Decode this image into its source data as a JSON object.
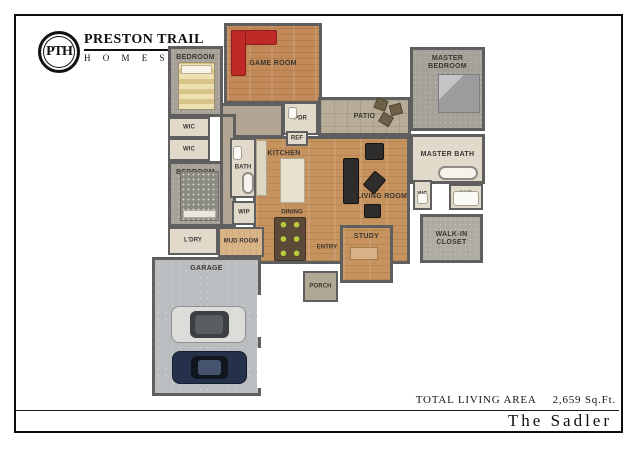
{
  "brand": {
    "monogram": "PTH",
    "name_line1": "PRESTON TRAIL",
    "name_line2": "H O M E S"
  },
  "footer": {
    "total_label": "TOTAL LIVING AREA",
    "total_value": "2,659 Sq.Ft.",
    "plan_name": "The Sadler"
  },
  "floorplan": {
    "colors": {
      "wall": "#5f5f5f",
      "wood": "#c6925d",
      "woodGame": "#c18a58",
      "woodLight": "#d9b487",
      "carpet": "#a5a199",
      "carpetWalkin": "#aeaba1",
      "tile": "#e1dacb",
      "taupe": "#b2a593",
      "patio": "#b7ad99",
      "concrete": "#babdbf",
      "porch": "#b1a795",
      "sofaRed": "#bf2a27",
      "seatDark": "#2e2d2b",
      "tableBrown": "#5c4a39",
      "chairGreen": "#b9cc3d"
    },
    "rooms": [
      {
        "id": "hall-upper",
        "label": "",
        "x": 220,
        "y": 103,
        "w": 64,
        "h": 35,
        "floor": "taupe",
        "labelAt": "center"
      },
      {
        "id": "hall-left",
        "label": "",
        "x": 220,
        "y": 114,
        "w": 16,
        "h": 113,
        "floor": "taupe",
        "labelAt": "center"
      },
      {
        "id": "great-room",
        "label": "",
        "x": 253,
        "y": 136,
        "w": 157,
        "h": 128,
        "floor": "wood",
        "labelAt": "center"
      },
      {
        "id": "game-room",
        "label": "GAME ROOM",
        "x": 224,
        "y": 23,
        "w": 98,
        "h": 81,
        "floor": "woodgame",
        "labelAt": "center"
      },
      {
        "id": "bedroom-top",
        "label": "BEDROOM",
        "x": 168,
        "y": 46,
        "w": 55,
        "h": 71,
        "floor": "carpet",
        "labelAt": "top"
      },
      {
        "id": "wic-1",
        "label": "WIC",
        "x": 168,
        "y": 117,
        "w": 42,
        "h": 21,
        "floor": "tile",
        "labelAt": "center",
        "small": true
      },
      {
        "id": "wic-2",
        "label": "WIC",
        "x": 168,
        "y": 138,
        "w": 42,
        "h": 23,
        "floor": "tile",
        "labelAt": "center",
        "small": true
      },
      {
        "id": "bedroom-left",
        "label": "BEDROOM",
        "x": 168,
        "y": 161,
        "w": 55,
        "h": 66,
        "floor": "carpet",
        "labelAt": "top"
      },
      {
        "id": "laundry",
        "label": "L'DRY",
        "x": 168,
        "y": 227,
        "w": 50,
        "h": 28,
        "floor": "tile",
        "labelAt": "center",
        "small": true
      },
      {
        "id": "mud-room",
        "label": "MUD ROOM",
        "x": 218,
        "y": 227,
        "w": 46,
        "h": 30,
        "floor": "woodlight",
        "labelAt": "center",
        "small": true
      },
      {
        "id": "bath",
        "label": "BATH",
        "x": 230,
        "y": 138,
        "w": 26,
        "h": 60,
        "floor": "tile",
        "labelAt": "center",
        "small": true
      },
      {
        "id": "wip",
        "label": "WIP",
        "x": 232,
        "y": 201,
        "w": 24,
        "h": 24,
        "floor": "tile",
        "labelAt": "center",
        "small": true
      },
      {
        "id": "pdr",
        "label": "PDR",
        "x": 283,
        "y": 102,
        "w": 35,
        "h": 33,
        "floor": "tile",
        "labelAt": "center",
        "small": true
      },
      {
        "id": "ref-nook",
        "label": "REF",
        "x": 286,
        "y": 131,
        "w": 22,
        "h": 15,
        "floor": "tile",
        "labelAt": "center",
        "small": true
      },
      {
        "id": "patio",
        "label": "PATIO",
        "x": 318,
        "y": 97,
        "w": 93,
        "h": 39,
        "floor": "patio",
        "labelAt": "center"
      },
      {
        "id": "master-bedroom",
        "label": "MASTER BEDROOM",
        "x": 410,
        "y": 47,
        "w": 75,
        "h": 84,
        "floor": "carpet",
        "labelAt": "top"
      },
      {
        "id": "master-bath",
        "label": "MASTER BATH",
        "x": 410,
        "y": 134,
        "w": 75,
        "h": 50,
        "floor": "tile",
        "labelAt": "upper"
      },
      {
        "id": "wc",
        "label": "WC",
        "x": 413,
        "y": 180,
        "w": 19,
        "h": 30,
        "floor": "tile",
        "labelAt": "center",
        "small": true
      },
      {
        "id": "shower",
        "label": "SHR",
        "x": 449,
        "y": 184,
        "w": 34,
        "h": 26,
        "floor": "tile",
        "labelAt": "top",
        "small": true
      },
      {
        "id": "walk-in-closet",
        "label": "WALK-IN\nCLOSET",
        "x": 420,
        "y": 214,
        "w": 63,
        "h": 49,
        "floor": "carpetlight",
        "labelAt": "center"
      },
      {
        "id": "study",
        "label": "STUDY",
        "x": 340,
        "y": 225,
        "w": 53,
        "h": 58,
        "floor": "wood",
        "labelAt": "top"
      },
      {
        "id": "porch",
        "label": "PORCH",
        "x": 303,
        "y": 271,
        "w": 35,
        "h": 31,
        "floor": "porch",
        "labelAt": "center",
        "small": true
      },
      {
        "id": "garage",
        "label": "GARAGE",
        "x": 152,
        "y": 257,
        "w": 109,
        "h": 139,
        "floor": "concrete",
        "labelAt": "top"
      },
      {
        "id": "kitchen-zone",
        "label": "KITCHEN",
        "x": 262,
        "y": 148,
        "w": 44,
        "h": 12,
        "floor": "none",
        "labelAt": "center"
      },
      {
        "id": "dw-zone",
        "label": "DW",
        "x": 282,
        "y": 164,
        "w": 22,
        "h": 10,
        "floor": "none",
        "labelAt": "center",
        "small": true
      },
      {
        "id": "dining-zone",
        "label": "DINING",
        "x": 272,
        "y": 207,
        "w": 40,
        "h": 11,
        "floor": "none",
        "labelAt": "center",
        "small": true
      },
      {
        "id": "living-zone",
        "label": "LIVING ROOM",
        "x": 352,
        "y": 191,
        "w": 60,
        "h": 12,
        "floor": "none",
        "labelAt": "center"
      },
      {
        "id": "entry-zone",
        "label": "ENTRY",
        "x": 305,
        "y": 242,
        "w": 44,
        "h": 12,
        "floor": "none",
        "labelAt": "center",
        "small": true
      }
    ],
    "furniture": [
      {
        "id": "game-sofa-seat",
        "kind": "sofa-red",
        "x": 231,
        "y": 30,
        "w": 46,
        "h": 15
      },
      {
        "id": "game-sofa-back",
        "kind": "sofa-red",
        "x": 231,
        "y": 30,
        "w": 15,
        "h": 46
      },
      {
        "id": "guest-bed-top",
        "kind": "bed-striped",
        "x": 178,
        "y": 62,
        "w": 37,
        "h": 48
      },
      {
        "id": "guest-bed-left",
        "kind": "bed-dots",
        "x": 180,
        "y": 171,
        "w": 39,
        "h": 50
      },
      {
        "id": "master-bed",
        "kind": "bed-gray",
        "x": 438,
        "y": 74,
        "w": 42,
        "h": 39
      },
      {
        "id": "kitchen-island",
        "kind": "island",
        "x": 280,
        "y": 158,
        "w": 25,
        "h": 45
      },
      {
        "id": "kitchen-counter",
        "kind": "counter",
        "x": 256,
        "y": 140,
        "w": 11,
        "h": 56
      },
      {
        "id": "dining-table",
        "kind": "table-dining",
        "x": 274,
        "y": 217,
        "w": 32,
        "h": 44
      },
      {
        "id": "living-sofa",
        "kind": "seat-dark",
        "x": 343,
        "y": 158,
        "w": 16,
        "h": 46
      },
      {
        "id": "media-cabinet",
        "kind": "seat-dark",
        "x": 365,
        "y": 143,
        "w": 19,
        "h": 17
      },
      {
        "id": "living-chair-1",
        "kind": "seat-dark",
        "x": 367,
        "y": 173,
        "w": 15,
        "h": 19,
        "rot": 40
      },
      {
        "id": "living-chair-2",
        "kind": "seat-dark",
        "x": 364,
        "y": 204,
        "w": 17,
        "h": 14
      },
      {
        "id": "patio-chair-1",
        "kind": "patio-chair",
        "x": 375,
        "y": 99,
        "w": 12,
        "h": 11,
        "rot": 20
      },
      {
        "id": "patio-chair-2",
        "kind": "patio-chair",
        "x": 390,
        "y": 104,
        "w": 12,
        "h": 11,
        "rot": -15
      },
      {
        "id": "patio-chair-3",
        "kind": "patio-chair",
        "x": 380,
        "y": 114,
        "w": 12,
        "h": 11,
        "rot": 30
      },
      {
        "id": "master-tub",
        "kind": "tub",
        "x": 438,
        "y": 166,
        "w": 40,
        "h": 14
      },
      {
        "id": "shower-base",
        "kind": "fixture",
        "x": 453,
        "y": 191,
        "w": 26,
        "h": 15
      },
      {
        "id": "bath-tub",
        "kind": "tub",
        "x": 242,
        "y": 172,
        "w": 12,
        "h": 22
      },
      {
        "id": "bath-sink",
        "kind": "fixture",
        "x": 233,
        "y": 146,
        "w": 9,
        "h": 14
      },
      {
        "id": "pdr-toilet",
        "kind": "fixture",
        "x": 288,
        "y": 107,
        "w": 9,
        "h": 12
      },
      {
        "id": "wc-toilet",
        "kind": "fixture",
        "x": 417,
        "y": 193,
        "w": 11,
        "h": 11
      },
      {
        "id": "study-desk",
        "kind": "desk",
        "x": 350,
        "y": 247,
        "w": 28,
        "h": 13
      },
      {
        "id": "car-silver",
        "kind": "car-silver",
        "x": 171,
        "y": 306,
        "w": 75,
        "h": 37
      },
      {
        "id": "car-navy",
        "kind": "car-navy",
        "x": 172,
        "y": 351,
        "w": 75,
        "h": 33
      },
      {
        "id": "garage-door-1",
        "kind": "gap",
        "x": 257,
        "y": 295,
        "w": 7,
        "h": 42
      },
      {
        "id": "garage-door-2",
        "kind": "gap",
        "x": 257,
        "y": 348,
        "w": 7,
        "h": 40
      }
    ]
  }
}
